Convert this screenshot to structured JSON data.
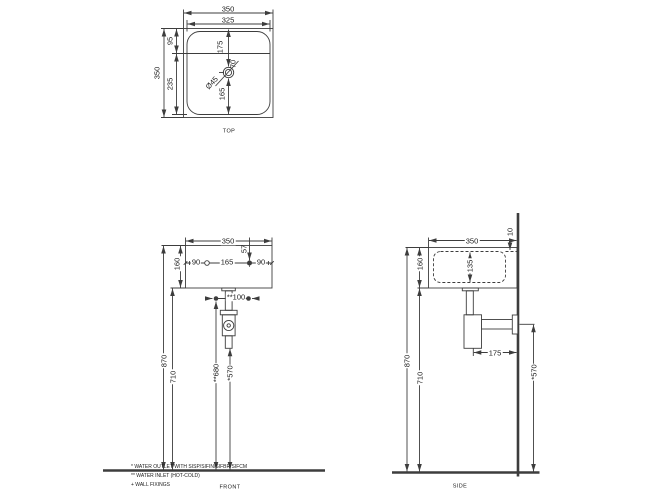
{
  "views": {
    "top": {
      "label": "TOP",
      "dim_width_outer": "350",
      "dim_width_inner": "325",
      "dim_top_to_ledge": "95",
      "dim_depth_total": "350",
      "dim_ledge_to_front": "235",
      "dim_top_to_drain": "175",
      "dim_drain_outer": "70",
      "dim_drain_diameter": "Ø45",
      "dim_drain_to_front": "165"
    },
    "front": {
      "label": "FRONT",
      "dim_width": "350",
      "dim_height": "160",
      "dim_left_to_fixing": "90",
      "dim_fixing_spacing": "165",
      "dim_fixing_to_right": "90",
      "dim_top_to_fixing": "57",
      "dim_inlet_spacing": "**100",
      "dim_rim_to_floor": "870",
      "dim_underside_to_floor": "710",
      "dim_inlet_to_floor": "**680",
      "dim_outlet_to_floor": "*570"
    },
    "side": {
      "label": "SIDE",
      "dim_depth": "350",
      "dim_back_rim": "10",
      "dim_height": "160",
      "dim_bowl_depth": "135",
      "dim_trap_to_wall": "175",
      "dim_rim_to_floor": "870",
      "dim_underside_to_floor": "710",
      "dim_outlet_to_floor": "*570"
    }
  },
  "notes": [
    "* WATER OUTLET WITH SISP/SIFIN/SIFBR/SIFCM",
    "** WATER INLET  (HOT-COLD)",
    "+ WALL FIXINGS"
  ]
}
